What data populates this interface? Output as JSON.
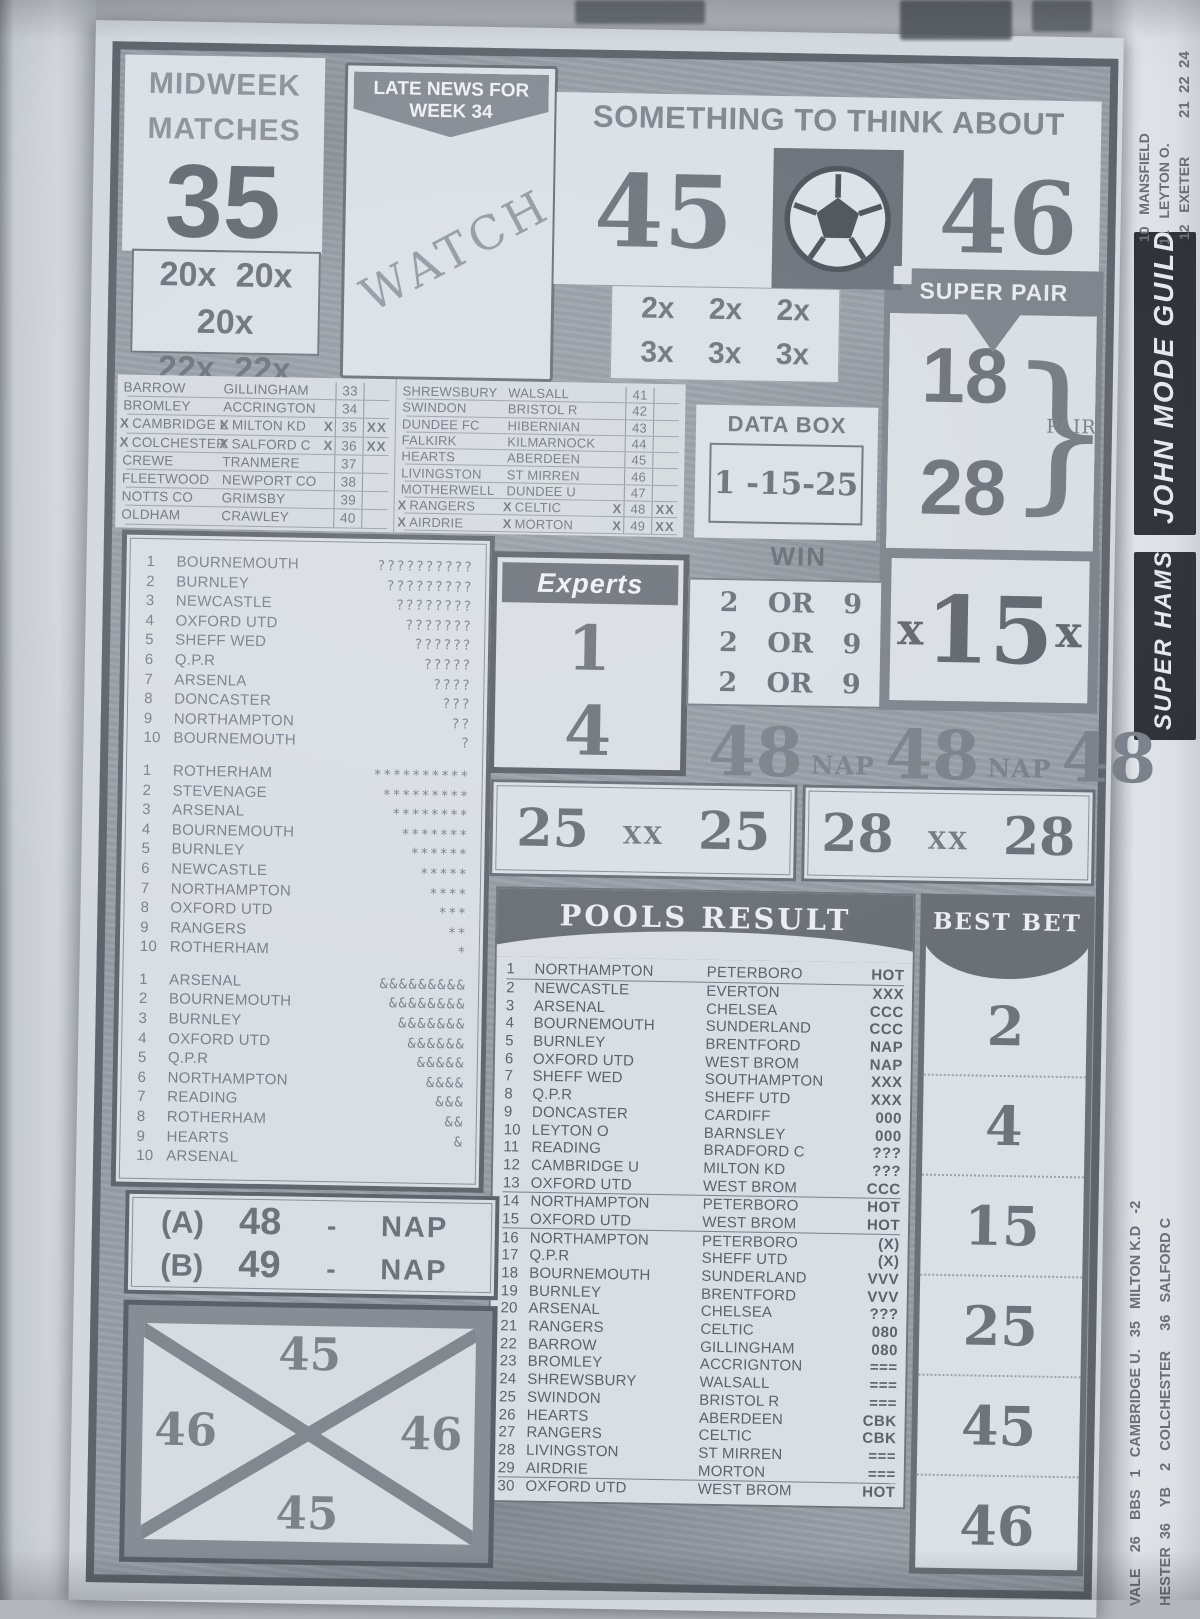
{
  "colors": {
    "paper": "#d6dbe2",
    "panel": "#dce1e7",
    "ink_dark": "#565b63",
    "ink_mid": "#6e737b",
    "ink_faded": "#868c94",
    "frame": "#5f646c",
    "side_banner_black": "#2e3238"
  },
  "masthead": {
    "midweek_line1": "MIDWEEK",
    "midweek_line2": "MATCHES",
    "week_number": "35",
    "mult_row1": "20x 20x 20x",
    "mult_row2": "22x 22x 22x",
    "late_news_line1": "LATE NEWS FOR",
    "late_news_line2": "WEEK 34",
    "watch_stamp": "WATCH",
    "think_title": "SOMETHING TO THINK ABOUT",
    "think_left": "45",
    "think_right": "46",
    "ball_icon": "soccer-ball",
    "mult2_row1": "2x 2x 2x",
    "mult2_row2": "3x 3x 3x"
  },
  "super_pair": {
    "title": "SUPER PAIR",
    "top": "18",
    "bottom": "28",
    "brace": "}",
    "label": "PAIR"
  },
  "fixtures_left": [
    {
      "hm": "",
      "home": "BARROW",
      "am": "",
      "away": "GILLINGHAM",
      "tail": "",
      "num": "33",
      "xx": ""
    },
    {
      "hm": "",
      "home": "BROMLEY",
      "am": "",
      "away": "ACCRINGTON",
      "tail": "",
      "num": "34",
      "xx": ""
    },
    {
      "hm": "X",
      "home": "CAMBRIDGE U",
      "am": "X",
      "away": "MILTON KD",
      "tail": "X",
      "num": "35",
      "xx": "XX"
    },
    {
      "hm": "X",
      "home": "COLCHESTER",
      "am": "X",
      "away": "SALFORD C",
      "tail": "X",
      "num": "36",
      "xx": "XX"
    },
    {
      "hm": "",
      "home": "CREWE",
      "am": "",
      "away": "TRANMERE",
      "tail": "",
      "num": "37",
      "xx": ""
    },
    {
      "hm": "",
      "home": "FLEETWOOD",
      "am": "",
      "away": "NEWPORT CO",
      "tail": "",
      "num": "38",
      "xx": ""
    },
    {
      "hm": "",
      "home": "NOTTS CO",
      "am": "",
      "away": "GRIMSBY",
      "tail": "",
      "num": "39",
      "xx": ""
    },
    {
      "hm": "",
      "home": "OLDHAM",
      "am": "",
      "away": "CRAWLEY",
      "tail": "",
      "num": "40",
      "xx": ""
    }
  ],
  "fixtures_right": [
    {
      "hm": "",
      "home": "SHREWSBURY",
      "am": "",
      "away": "WALSALL",
      "tail": "",
      "num": "41",
      "xx": ""
    },
    {
      "hm": "",
      "home": "SWINDON",
      "am": "",
      "away": "BRISTOL R",
      "tail": "",
      "num": "42",
      "xx": ""
    },
    {
      "hm": "",
      "home": "DUNDEE FC",
      "am": "",
      "away": "HIBERNIAN",
      "tail": "",
      "num": "43",
      "xx": ""
    },
    {
      "hm": "",
      "home": "FALKIRK",
      "am": "",
      "away": "KILMARNOCK",
      "tail": "",
      "num": "44",
      "xx": ""
    },
    {
      "hm": "",
      "home": "HEARTS",
      "am": "",
      "away": "ABERDEEN",
      "tail": "",
      "num": "45",
      "xx": ""
    },
    {
      "hm": "",
      "home": "LIVINGSTON",
      "am": "",
      "away": "ST MIRREN",
      "tail": "",
      "num": "46",
      "xx": ""
    },
    {
      "hm": "",
      "home": "MOTHERWELL",
      "am": "",
      "away": "DUNDEE U",
      "tail": "",
      "num": "47",
      "xx": ""
    },
    {
      "hm": "X",
      "home": "RANGERS",
      "am": "X",
      "away": "CELTIC",
      "tail": "X",
      "num": "48",
      "xx": "XX"
    },
    {
      "hm": "X",
      "home": "AIRDRIE",
      "am": "X",
      "away": "MORTON",
      "tail": "X",
      "num": "49",
      "xx": "XX"
    }
  ],
  "data_box": {
    "title": "DATA BOX",
    "value": "1 -15-25"
  },
  "experts": {
    "title": "Experts",
    "top": "1",
    "bottom": "4"
  },
  "win": {
    "title": "WIN",
    "rows": [
      "2 OR 9",
      "2 OR 9",
      "2 OR 9"
    ]
  },
  "x15": {
    "left_x": "x",
    "value": "15",
    "right_x": "x"
  },
  "nap_strip": {
    "n1": "48",
    "t1": "NAP",
    "n2": "48",
    "t2": "NAP",
    "n3": "48"
  },
  "xx_box_25": {
    "left": "25",
    "mid": "XX",
    "right": "25"
  },
  "xx_box_28": {
    "left": "28",
    "mid": "XX",
    "right": "28"
  },
  "tip_list_q": [
    {
      "num": "1",
      "team": "BOURNEMOUTH",
      "marks": "??????????"
    },
    {
      "num": "2",
      "team": "BURNLEY",
      "marks": "?????????"
    },
    {
      "num": "3",
      "team": "NEWCASTLE",
      "marks": "????????"
    },
    {
      "num": "4",
      "team": "OXFORD UTD",
      "marks": "???????"
    },
    {
      "num": "5",
      "team": "SHEFF WED",
      "marks": "??????"
    },
    {
      "num": "6",
      "team": "Q.P.R",
      "marks": "?????"
    },
    {
      "num": "7",
      "team": "ARSENLA",
      "marks": "????"
    },
    {
      "num": "8",
      "team": "DONCASTER",
      "marks": "???"
    },
    {
      "num": "9",
      "team": "NORTHAMPTON",
      "marks": "??"
    },
    {
      "num": "10",
      "team": "BOURNEMOUTH",
      "marks": "?"
    }
  ],
  "tip_list_star": [
    {
      "num": "1",
      "team": "ROTHERHAM",
      "marks": "**********"
    },
    {
      "num": "2",
      "team": "STEVENAGE",
      "marks": "*********"
    },
    {
      "num": "3",
      "team": "ARSENAL",
      "marks": "********"
    },
    {
      "num": "4",
      "team": "BOURNEMOUTH",
      "marks": "*******"
    },
    {
      "num": "5",
      "team": "BURNLEY",
      "marks": "******"
    },
    {
      "num": "6",
      "team": "NEWCASTLE",
      "marks": "*****"
    },
    {
      "num": "7",
      "team": "NORTHAMPTON",
      "marks": "****"
    },
    {
      "num": "8",
      "team": "OXFORD UTD",
      "marks": "***"
    },
    {
      "num": "9",
      "team": "RANGERS",
      "marks": "**"
    },
    {
      "num": "10",
      "team": "ROTHERHAM",
      "marks": "*"
    }
  ],
  "tip_list_amp": [
    {
      "num": "1",
      "team": "ARSENAL",
      "marks": "&&&&&&&&&"
    },
    {
      "num": "2",
      "team": "BOURNEMOUTH",
      "marks": "&&&&&&&&"
    },
    {
      "num": "3",
      "team": "BURNLEY",
      "marks": "&&&&&&&"
    },
    {
      "num": "4",
      "team": "OXFORD UTD",
      "marks": "&&&&&&"
    },
    {
      "num": "5",
      "team": "Q.P.R",
      "marks": "&&&&&"
    },
    {
      "num": "6",
      "team": "NORTHAMPTON",
      "marks": "&&&&"
    },
    {
      "num": "7",
      "team": "READING",
      "marks": "&&&"
    },
    {
      "num": "8",
      "team": "ROTHERHAM",
      "marks": "&&"
    },
    {
      "num": "9",
      "team": "HEARTS",
      "marks": "&"
    },
    {
      "num": "10",
      "team": "ARSENAL",
      "marks": ""
    }
  ],
  "nap_box": {
    "rows": [
      {
        "label": "(A)",
        "num": "48",
        "dash": "-",
        "tag": "NAP"
      },
      {
        "label": "(B)",
        "num": "49",
        "dash": "-",
        "tag": "NAP"
      }
    ]
  },
  "cross_box": {
    "top": "45",
    "left": "46",
    "right": "46",
    "bottom": "45"
  },
  "pools_result": {
    "title": "POOLS RESULT",
    "rows": [
      {
        "num": "1",
        "home": "NORTHAMPTON",
        "away": "PETERBORO",
        "code": "HOT"
      },
      {
        "num": "2",
        "home": "NEWCASTLE",
        "away": "EVERTON",
        "code": "XXX"
      },
      {
        "num": "3",
        "home": "ARSENAL",
        "away": "CHELSEA",
        "code": "CCC"
      },
      {
        "num": "4",
        "home": "BOURNEMOUTH",
        "away": "SUNDERLAND",
        "code": "CCC"
      },
      {
        "num": "5",
        "home": "BURNLEY",
        "away": "BRENTFORD",
        "code": "NAP"
      },
      {
        "num": "6",
        "home": "OXFORD UTD",
        "away": "WEST BROM",
        "code": "NAP"
      },
      {
        "num": "7",
        "home": "SHEFF WED",
        "away": "SOUTHAMPTON",
        "code": "XXX"
      },
      {
        "num": "8",
        "home": "Q.P.R",
        "away": "SHEFF UTD",
        "code": "XXX"
      },
      {
        "num": "9",
        "home": "DONCASTER",
        "away": "CARDIFF",
        "code": "000"
      },
      {
        "num": "10",
        "home": "LEYTON O",
        "away": "BARNSLEY",
        "code": "000"
      },
      {
        "num": "11",
        "home": "READING",
        "away": "BRADFORD C",
        "code": "???"
      },
      {
        "num": "12",
        "home": "CAMBRIDGE U",
        "away": "MILTON KD",
        "code": "???"
      },
      {
        "num": "13",
        "home": "OXFORD UTD",
        "away": "WEST BROM",
        "code": "CCC"
      },
      {
        "num": "14",
        "home": "NORTHAMPTON",
        "away": "PETERBORO",
        "code": "HOT"
      },
      {
        "num": "15",
        "home": "OXFORD UTD",
        "away": "WEST BROM",
        "code": "HOT"
      },
      {
        "num": "16",
        "home": "NORTHAMPTON",
        "away": "PETERBORO",
        "code": "(X)"
      },
      {
        "num": "17",
        "home": "Q.P.R",
        "away": "SHEFF UTD",
        "code": "(X)"
      },
      {
        "num": "18",
        "home": "BOURNEMOUTH",
        "away": "SUNDERLAND",
        "code": "VVV"
      },
      {
        "num": "19",
        "home": "BURNLEY",
        "away": "BRENTFORD",
        "code": "VVV"
      },
      {
        "num": "20",
        "home": "ARSENAL",
        "away": "CHELSEA",
        "code": "???"
      },
      {
        "num": "21",
        "home": "RANGERS",
        "away": "CELTIC",
        "code": "080"
      },
      {
        "num": "22",
        "home": "BARROW",
        "away": "GILLINGHAM",
        "code": "080"
      },
      {
        "num": "23",
        "home": "BROMLEY",
        "away": "ACCRIGNTON",
        "code": "==="
      },
      {
        "num": "24",
        "home": "SHREWSBURY",
        "away": "WALSALL",
        "code": "==="
      },
      {
        "num": "25",
        "home": "SWINDON",
        "away": "BRISTOL R",
        "code": "==="
      },
      {
        "num": "26",
        "home": "HEARTS",
        "away": "ABERDEEN",
        "code": "CBK"
      },
      {
        "num": "27",
        "home": "RANGERS",
        "away": "CELTIC",
        "code": "CBK"
      },
      {
        "num": "28",
        "home": "LIVINGSTON",
        "away": "ST MIRREN",
        "code": "==="
      },
      {
        "num": "29",
        "home": "AIRDRIE",
        "away": "MORTON",
        "code": "==="
      },
      {
        "num": "30",
        "home": "OXFORD UTD",
        "away": "WEST BROM",
        "code": "HOT"
      }
    ]
  },
  "best_bet": {
    "title": "BEST BET",
    "numbers": [
      "2",
      "4",
      "15",
      "25",
      "45",
      "46"
    ]
  },
  "side_strip": {
    "top_numbers": "21  22  24",
    "fixture_line1": "10   MANSFIELD",
    "fixture_line2": "11   LEYTON O.",
    "fixture_line3": "12   EXETER",
    "banner_top": "JOHN MODE GUILD",
    "banner_bottom": "SUPER HAMS",
    "lower_line1": "VALE    26    BBS   1   CAMBRIDGE U.   35   MILTON K.D   -2",
    "lower_line2": "HESTER  36    YB    2   COLCHESTER     36   SALFORD C"
  }
}
